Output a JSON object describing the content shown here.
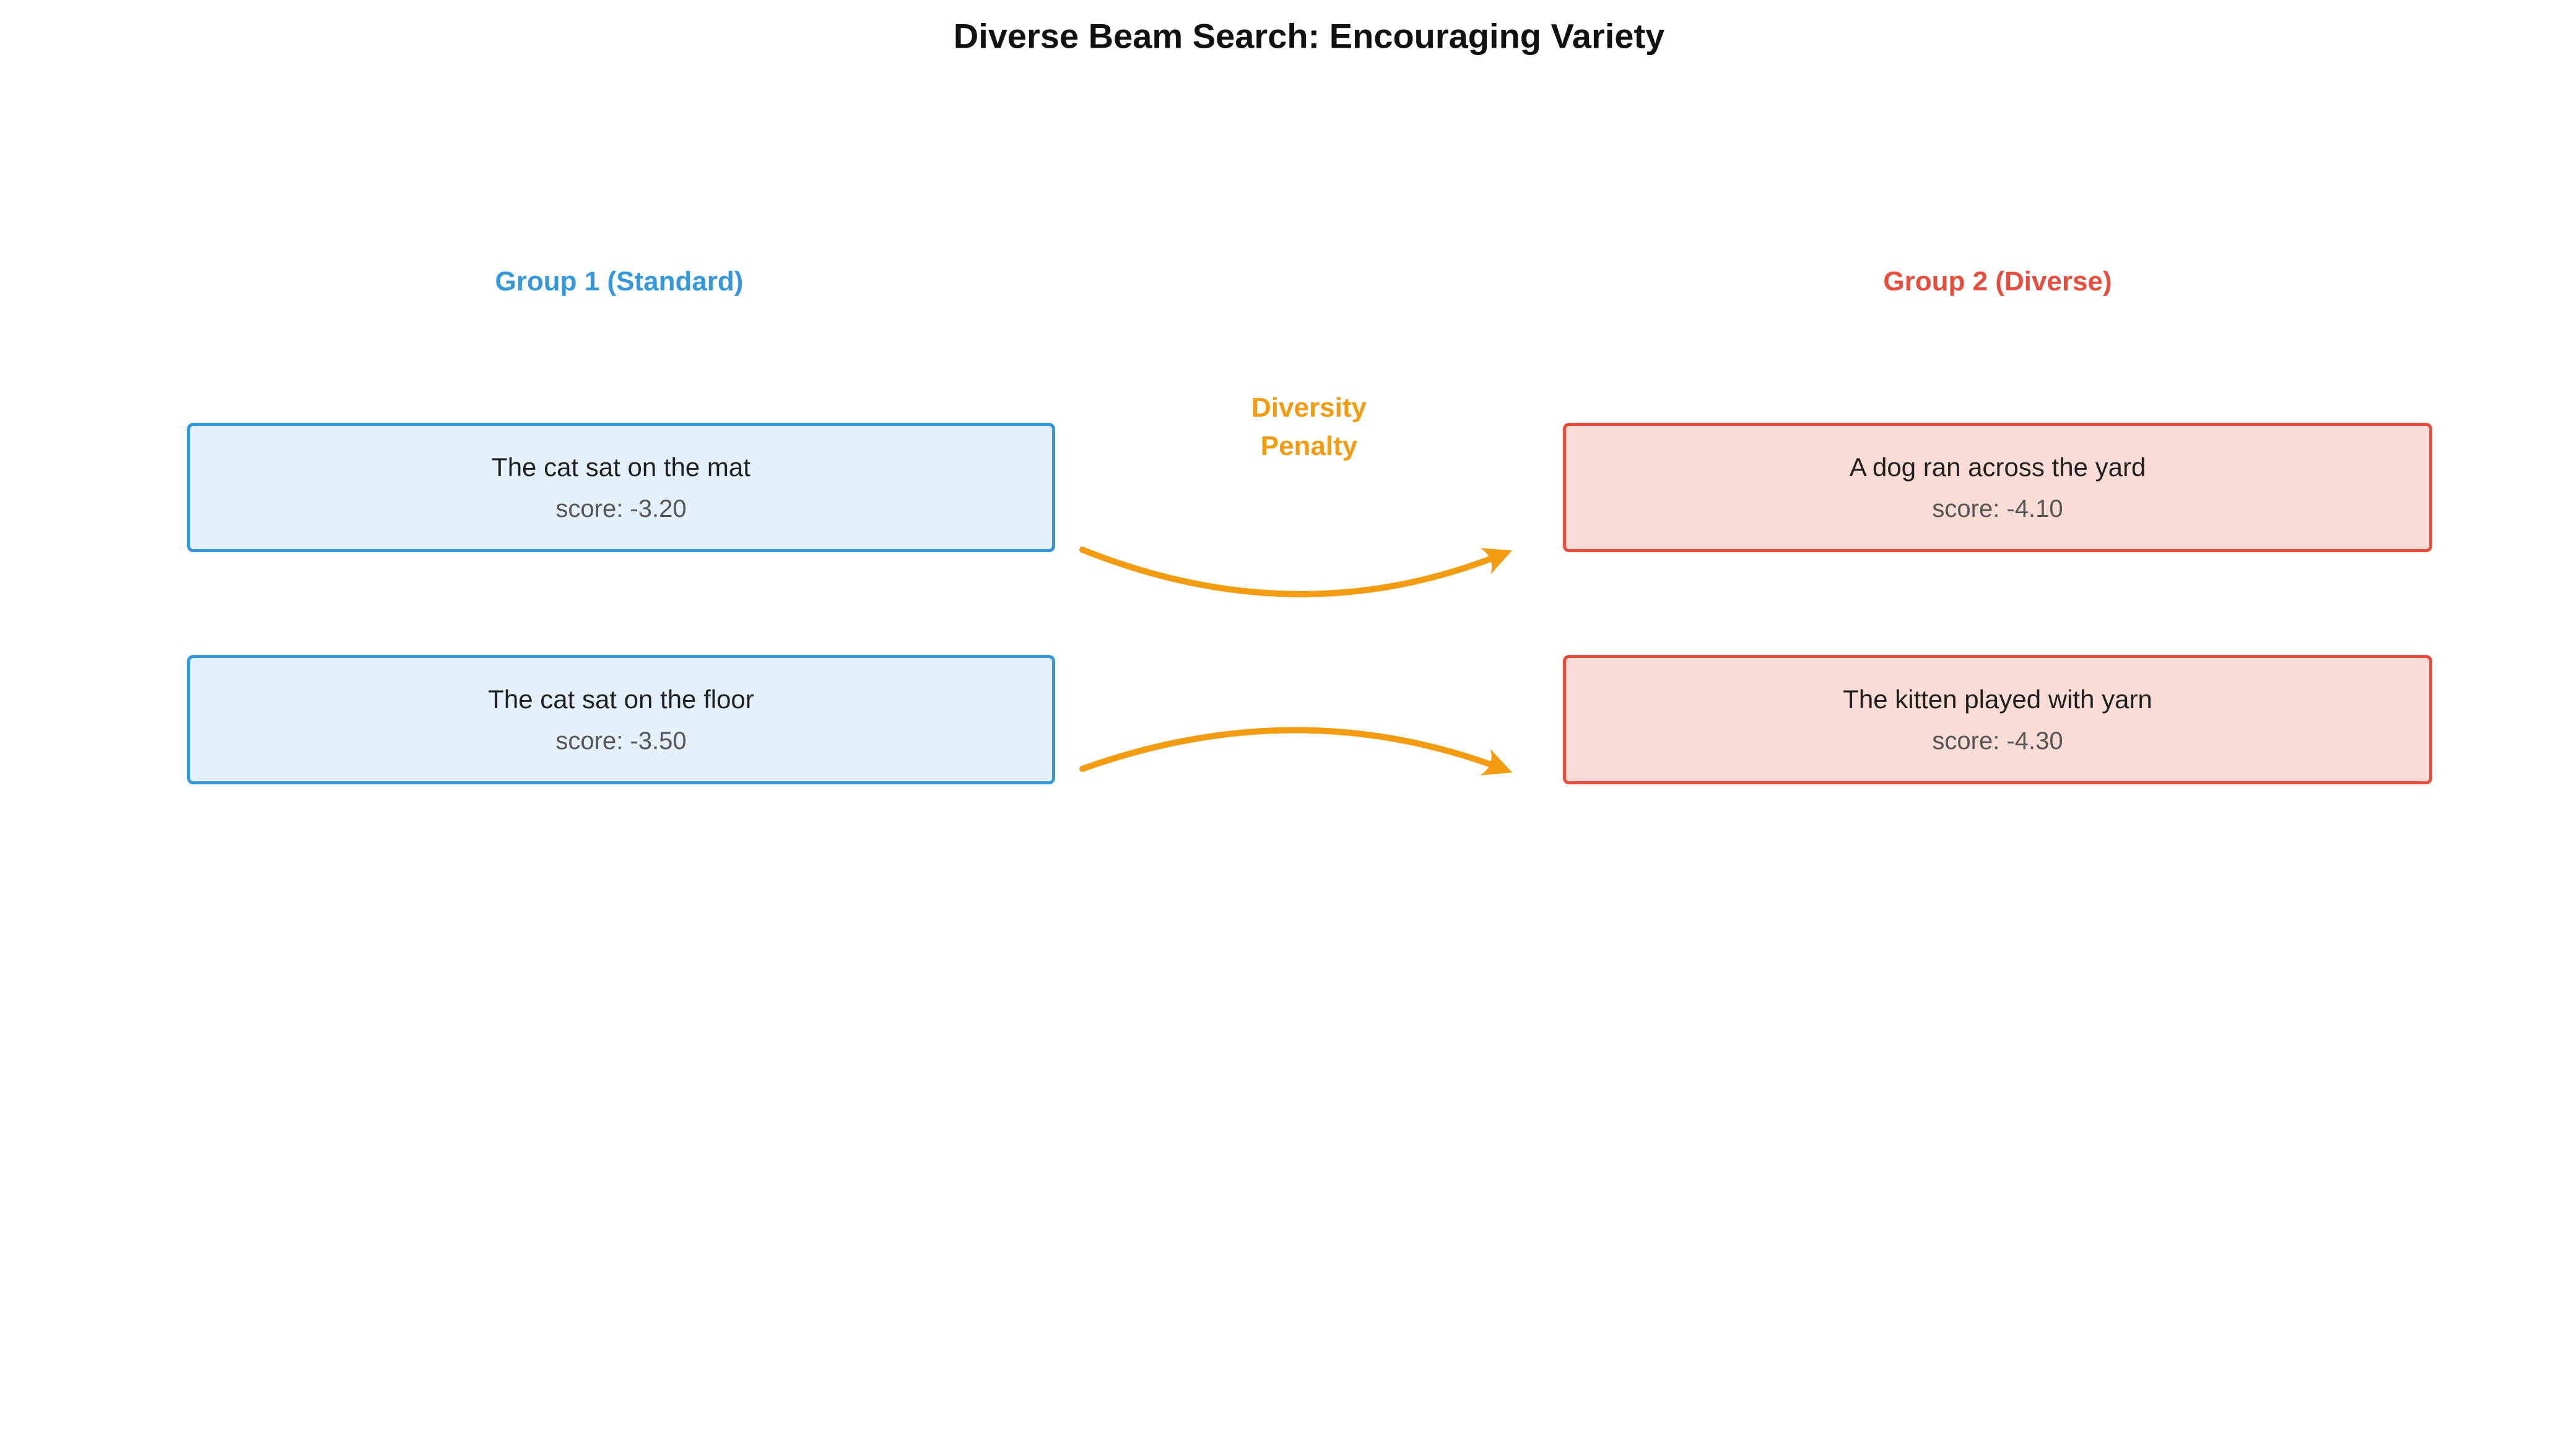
{
  "title": "Diverse Beam Search: Encouraging Variety",
  "penalty": {
    "line1": "Diversity",
    "line2": "Penalty"
  },
  "groups": [
    {
      "label": "Group 1 (Standard)",
      "beams": [
        {
          "text": "The cat sat on the mat",
          "score": "score: -3.20"
        },
        {
          "text": "The cat sat on the floor",
          "score": "score: -3.50"
        }
      ]
    },
    {
      "label": "Group 2 (Diverse)",
      "beams": [
        {
          "text": "A dog ran across the yard",
          "score": "score: -4.10"
        },
        {
          "text": "The kitten played with yarn",
          "score": "score: -4.30"
        }
      ]
    }
  ],
  "colors": {
    "group1_accent": "#3498db",
    "group1_fill": "#e4f1fb",
    "group2_accent": "#e74c3c",
    "group2_fill": "#fadcd7",
    "penalty_accent": "#f39c12",
    "title_text": "#111111",
    "beam_text": "#1f1f1f",
    "score_text": "#555555"
  }
}
